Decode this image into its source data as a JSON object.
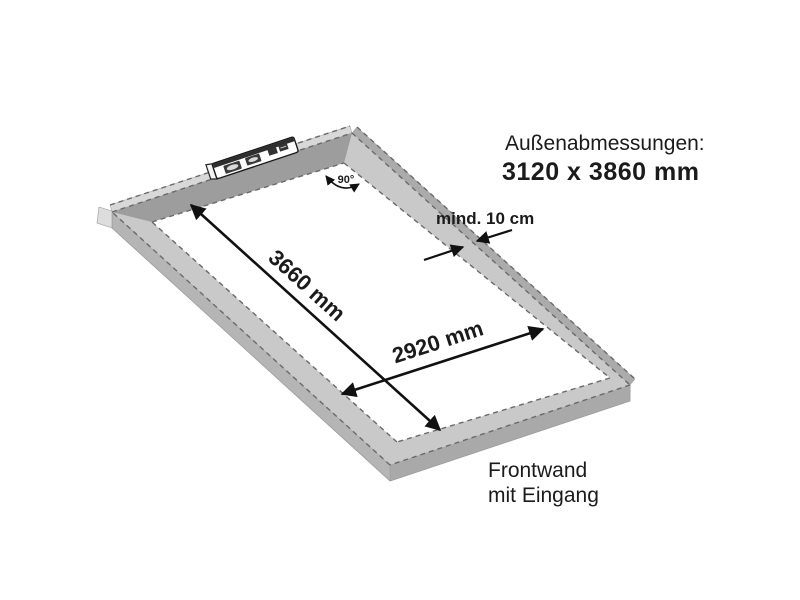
{
  "diagram": {
    "caption_line1": "Außenabmessungen:",
    "caption_line2": "3120 x 3860 mm",
    "dim_length": "3660 mm",
    "dim_width": "2920 mm",
    "clearance": "mind. 10 cm",
    "angle": "90°",
    "front_label_line1": "Frontwand",
    "front_label_line2": "mit Eingang"
  },
  "colors": {
    "background": "#ffffff",
    "text": "#1b1b1b",
    "arrow": "#111111",
    "frame_top_face": "#c9c9c9",
    "frame_top_face_shaded": "#9d9d9d",
    "frame_side_face": "#b5b5b5",
    "frame_side_face_dark": "#a9a9a9",
    "frame_outer_strip_light": "#d8d8d8",
    "frame_outer_strip_dark": "#ababab",
    "frame_end_cap": "#dddddd",
    "dashed_edge": "#6a6a6a",
    "interior": "#ffffff"
  }
}
